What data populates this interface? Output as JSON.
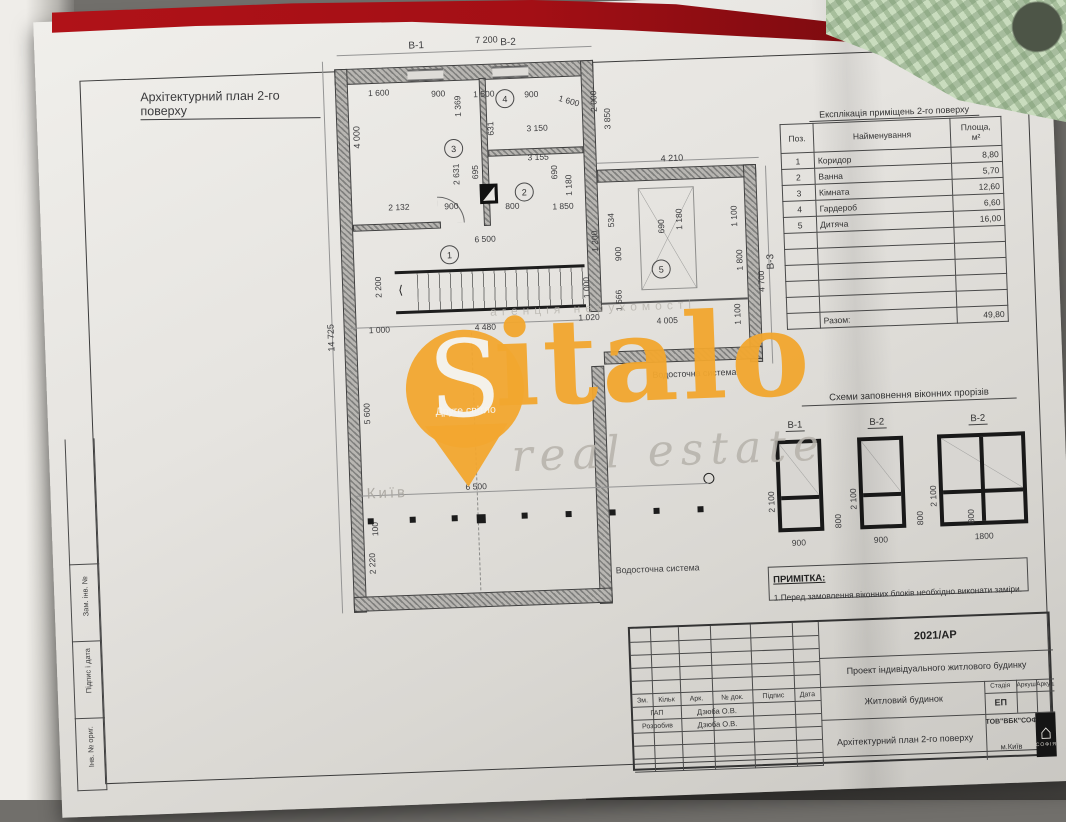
{
  "page_title": "Архітектурний план 2-го поверху",
  "watermark": {
    "letter": "S",
    "brand_rest": "italo",
    "tagline": "real estate",
    "slogan": "Друге світло",
    "city": "Київ",
    "agency": "агенція нерухомості",
    "orange": "#f2a72f"
  },
  "plan": {
    "dimensions": [
      {
        "t": "В-1",
        "x": 420,
        "y": 34,
        "s": 10
      },
      {
        "t": "7 200",
        "x": 487,
        "y": 31,
        "s": 9
      },
      {
        "t": "В-2",
        "x": 512,
        "y": 34,
        "s": 10
      },
      {
        "t": "1 600",
        "x": 378,
        "y": 80
      },
      {
        "t": "900",
        "x": 441,
        "y": 83
      },
      {
        "t": "1 500",
        "x": 483,
        "y": 85
      },
      {
        "t": "900",
        "x": 534,
        "y": 87
      },
      {
        "t": "1 600",
        "x": 570,
        "y": 92,
        "r": -18
      },
      {
        "t": "1 369",
        "x": 462,
        "y": 112,
        "r": 90
      },
      {
        "t": "4 000",
        "x": 360,
        "y": 140,
        "r": 90,
        "s": 9
      },
      {
        "t": "631",
        "x": 494,
        "y": 132,
        "r": 90
      },
      {
        "t": "3 150",
        "x": 535,
        "y": 121
      },
      {
        "t": "3 155",
        "x": 535,
        "y": 150
      },
      {
        "t": "2 000",
        "x": 598,
        "y": 112,
        "r": 90
      },
      {
        "t": "3 850",
        "x": 611,
        "y": 130,
        "r": 90
      },
      {
        "t": "2 631",
        "x": 458,
        "y": 180,
        "r": 90
      },
      {
        "t": "695",
        "x": 477,
        "y": 175,
        "r": 90
      },
      {
        "t": "690",
        "x": 556,
        "y": 178,
        "r": 90
      },
      {
        "t": "1 180",
        "x": 570,
        "y": 195,
        "r": 90
      },
      {
        "t": "2 132",
        "x": 394,
        "y": 195
      },
      {
        "t": "900",
        "x": 450,
        "y": 196
      },
      {
        "t": "800",
        "x": 511,
        "y": 198
      },
      {
        "t": "1 850",
        "x": 558,
        "y": 200
      },
      {
        "t": "4 210",
        "x": 668,
        "y": 156,
        "s": 9
      },
      {
        "t": "534",
        "x": 611,
        "y": 228,
        "r": 90
      },
      {
        "t": "690",
        "x": 661,
        "y": 236,
        "r": 90
      },
      {
        "t": "1 180",
        "x": 679,
        "y": 233,
        "r": 90
      },
      {
        "t": "1 100",
        "x": 734,
        "y": 232,
        "r": 90
      },
      {
        "t": "900",
        "x": 617,
        "y": 262,
        "r": 90
      },
      {
        "t": "1 800",
        "x": 738,
        "y": 276,
        "r": 90
      },
      {
        "t": "В-3",
        "x": 769,
        "y": 276,
        "r": 90,
        "s": 10
      },
      {
        "t": "4 700",
        "x": 759,
        "y": 298,
        "r": 90
      },
      {
        "t": "1 566",
        "x": 616,
        "y": 312,
        "r": 90
      },
      {
        "t": "1 100",
        "x": 734,
        "y": 330,
        "r": 90
      },
      {
        "t": "4 005",
        "x": 658,
        "y": 318
      },
      {
        "t": "6 500",
        "x": 479,
        "y": 230
      },
      {
        "t": "1 200",
        "x": 594,
        "y": 252,
        "r": 90
      },
      {
        "t": "2 200",
        "x": 376,
        "y": 290,
        "r": 90
      },
      {
        "t": "1 000",
        "x": 584,
        "y": 298,
        "r": 90
      },
      {
        "t": "1 000",
        "x": 370,
        "y": 317
      },
      {
        "t": "4 480",
        "x": 476,
        "y": 318
      },
      {
        "t": "1 020",
        "x": 580,
        "y": 312
      },
      {
        "t": "14 725",
        "x": 327,
        "y": 342,
        "r": 90,
        "s": 9
      },
      {
        "t": "5 600",
        "x": 360,
        "y": 416,
        "r": 90
      },
      {
        "t": "100",
        "x": 364,
        "y": 528,
        "r": 90
      },
      {
        "t": "2 220",
        "x": 360,
        "y": 566,
        "r": 90
      },
      {
        "t": "6 500",
        "x": 461,
        "y": 477
      }
    ],
    "rooms": [
      {
        "n": "1",
        "x": 444,
        "y": 240
      },
      {
        "n": "2",
        "x": 521,
        "y": 180
      },
      {
        "n": "3",
        "x": 452,
        "y": 134
      },
      {
        "n": "4",
        "x": 505,
        "y": 86
      },
      {
        "n": "5",
        "x": 655,
        "y": 262
      }
    ],
    "labels": [
      {
        "t": "Водосточна система",
        "x": 652,
        "y": 372
      },
      {
        "t": "Водосточна система",
        "x": 608,
        "y": 566
      }
    ]
  },
  "explication": {
    "title": "Експлікація приміщень 2-го поверху",
    "headers": [
      "Поз.",
      "Найменування",
      "Площа,\nм²"
    ],
    "rows": [
      [
        "1",
        "Коридор",
        "8,80"
      ],
      [
        "2",
        "Ванна",
        "5,70"
      ],
      [
        "3",
        "Кімната",
        "12,60"
      ],
      [
        "4",
        "Гардероб",
        "6,60"
      ],
      [
        "5",
        "Дитяча",
        "16,00"
      ]
    ],
    "empty_rows": 5,
    "total_label": "Разом:",
    "total_value": "49,80"
  },
  "window_schemes": {
    "title": "Схеми заповнення віконних прорізів",
    "items": [
      {
        "label": "В-1",
        "width": "900",
        "height": "2 100",
        "sill": "800"
      },
      {
        "label": "В-2",
        "width": "900",
        "height": "2 100",
        "sill": "800"
      },
      {
        "label": "В-2",
        "width": "1800",
        "height": "2 100",
        "sill": "800"
      }
    ]
  },
  "note": {
    "title": "ПРИМІТКА:",
    "text": "1.Перед замовлення віконних блоків необхідно виконати заміри."
  },
  "title_block": {
    "code": "2021/АР",
    "project": "Проект індивідуального житлового будинку",
    "object": "Житловий будинок",
    "drawing": "Архітектурний план 2-го поверху",
    "company": "ТОВ\"ВБК\"СОФІЯ\"",
    "company_city": "м.Київ",
    "stage_h": "Стадія",
    "sheet_h": "Аркуш",
    "sheets_h": "Аркушів",
    "stage": "ЕП",
    "cols": [
      "Зм.",
      "Кільк",
      "Арк.",
      "№ док.",
      "Підпис",
      "Дата"
    ],
    "rows": [
      {
        "role": "ГАП",
        "name": "Дзюба О.В."
      },
      {
        "role": "Розробив",
        "name": "Дзюба О.В."
      }
    ],
    "logo_glyph": "⌂",
    "logo_text": "СОФІЯ"
  },
  "side_strip": {
    "labels": [
      "Зам. інв. №",
      "Підпис і дата",
      "Інв. № ориг."
    ]
  }
}
